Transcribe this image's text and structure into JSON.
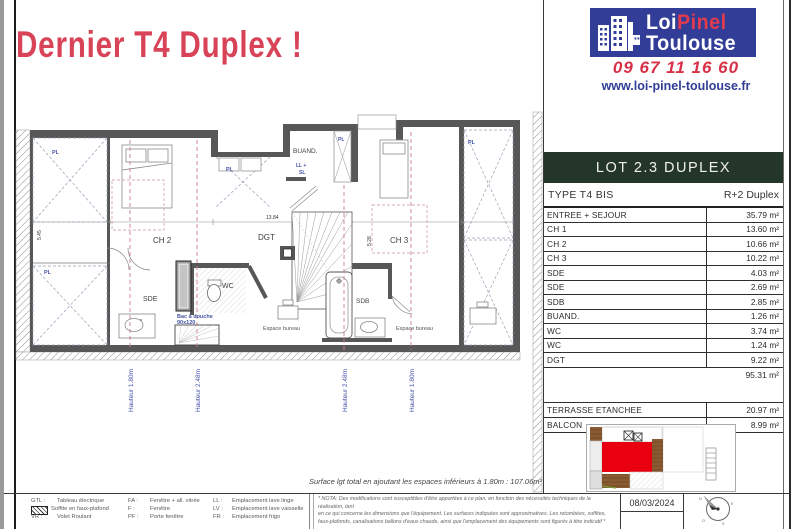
{
  "title": "Dernier T4 Duplex !",
  "logo": {
    "brand_word1": "Loi",
    "brand_word2": "Pinel",
    "brand_word3": "Toulouse",
    "phone": "09 67 11 16 60",
    "website": "www.loi-pinel-toulouse.fr",
    "brand_blue": "#313d96",
    "brand_red": "#e23b4e"
  },
  "lot_table": {
    "header": "LOT 2.3 DUPLEX",
    "header_bg": "#243629",
    "type_label": "TYPE T4 BIS",
    "type_value": "R+2 Duplex",
    "rows": [
      {
        "label": "ENTREE + SEJOUR",
        "value": "35.79 m²"
      },
      {
        "label": "CH 1",
        "value": "13.60 m²"
      },
      {
        "label": "CH 2",
        "value": "10.66 m²"
      },
      {
        "label": "CH 3",
        "value": "10.22 m²"
      },
      {
        "label": "SDE",
        "value": "4.03 m²"
      },
      {
        "label": "SDE",
        "value": "2.69 m²"
      },
      {
        "label": "SDB",
        "value": "2.85 m²"
      },
      {
        "label": "BUAND.",
        "value": "1.26 m²"
      },
      {
        "label": "WC",
        "value": "3.74 m²"
      },
      {
        "label": "WC",
        "value": "1.24 m²"
      },
      {
        "label": "DGT",
        "value": "9.22 m²"
      }
    ],
    "total_value": "95.31 m²",
    "outdoor_rows": [
      {
        "label": "TERRASSE ETANCHEE",
        "value": "20.97 m²"
      },
      {
        "label": "BALCON",
        "value": "8.99 m²"
      }
    ]
  },
  "plan": {
    "rooms": {
      "ch2": "CH 2",
      "ch3": "CH 3",
      "dgt": "DGT",
      "wc": "WC",
      "sde": "SDE",
      "sdb": "SDB",
      "buand": "BUAND.",
      "pl": "PL",
      "ll_plus": "LL +",
      "sl": "SL",
      "bac_line1": "Bac à douche",
      "bac_line2": "90x120",
      "bureau": "Espace bureau"
    },
    "heights": [
      "Hauteur 1.80m",
      "Hauteur 2.48m",
      "Hauteur 2.48m",
      "Hauteur 1.80m"
    ],
    "dims": {
      "d1": "13.84",
      "d2": "5.45",
      "d3": "5.28"
    },
    "surface_note": "Surface lgt total en ajoutant les espaces inférieurs à 1.80m : 107.06m²"
  },
  "footer": {
    "legend": [
      {
        "key": "GTL :",
        "label": "Tableau électrique"
      },
      {
        "key": "",
        "label": "Soffite en faux-plafond"
      },
      {
        "key": "VR :",
        "label": "Volet Roulant"
      },
      {
        "key": "FA :",
        "label": "Fenêtre + all. vitrée"
      },
      {
        "key": "F :",
        "label": "Fenêtre"
      },
      {
        "key": "PF :",
        "label": "Porte fenêtre"
      },
      {
        "key": "LL :",
        "label": "Emplacement lave linge"
      },
      {
        "key": "LV :",
        "label": "Emplacement lave vaisselle"
      },
      {
        "key": "FR :",
        "label": "Emplacement frigo"
      }
    ],
    "nota_line1": "* NOTA: Des modifications sont susceptibles d'être apportées à ce plan, en fonction des nécessités techniques de la réalisation, tant",
    "nota_line2": "en ce qui concerne les dimensions que l'équipement. Les surfaces indiquées sont approximatives. Les retombées, soffites,",
    "nota_line3": "faux-plafonds, canalisations ballons d'eaux chaude, ainsi que l'emplacement des équipements sont figurés à titre indicatif *",
    "date": "08/03/2024",
    "compass": {
      "n": "N",
      "e": "E",
      "s": "S",
      "o": "O"
    }
  }
}
